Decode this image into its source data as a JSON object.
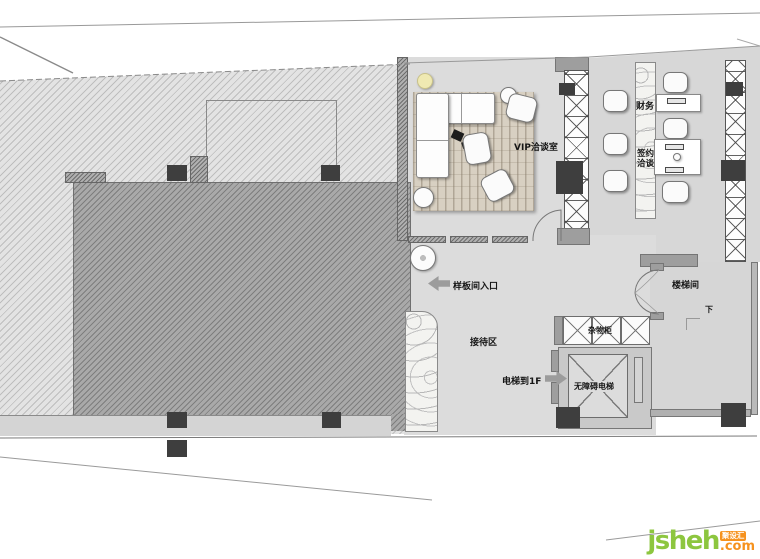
{
  "labels": {
    "vip_room": "VIP洽谈室",
    "finance": "财务",
    "signing_line1": "签约",
    "signing_line2": "洽谈",
    "storage_cabinet": "杂物柜",
    "accessible_elevator": "无障碍电梯",
    "stairwell": "楼梯间",
    "down": "下",
    "sample_room_entrance": "样板间入口",
    "reception_area": "接待区",
    "elevator_to_1f": "电梯到1F"
  },
  "watermark": {
    "brand": "jsheh",
    "suffix": ".com",
    "badge": "聚设汇"
  },
  "colors": {
    "floor": "#dcdcdc",
    "hatch_light": "#e3e3e3",
    "hatch_dark": "#a9a9a9",
    "column": "#3e3e3e",
    "wall": "#9e9e9e",
    "rug_wood": "#d8d0c2",
    "light_fixture": "#efe9b2",
    "watermark_green": "#8dc63f",
    "watermark_orange": "#f6921e"
  }
}
